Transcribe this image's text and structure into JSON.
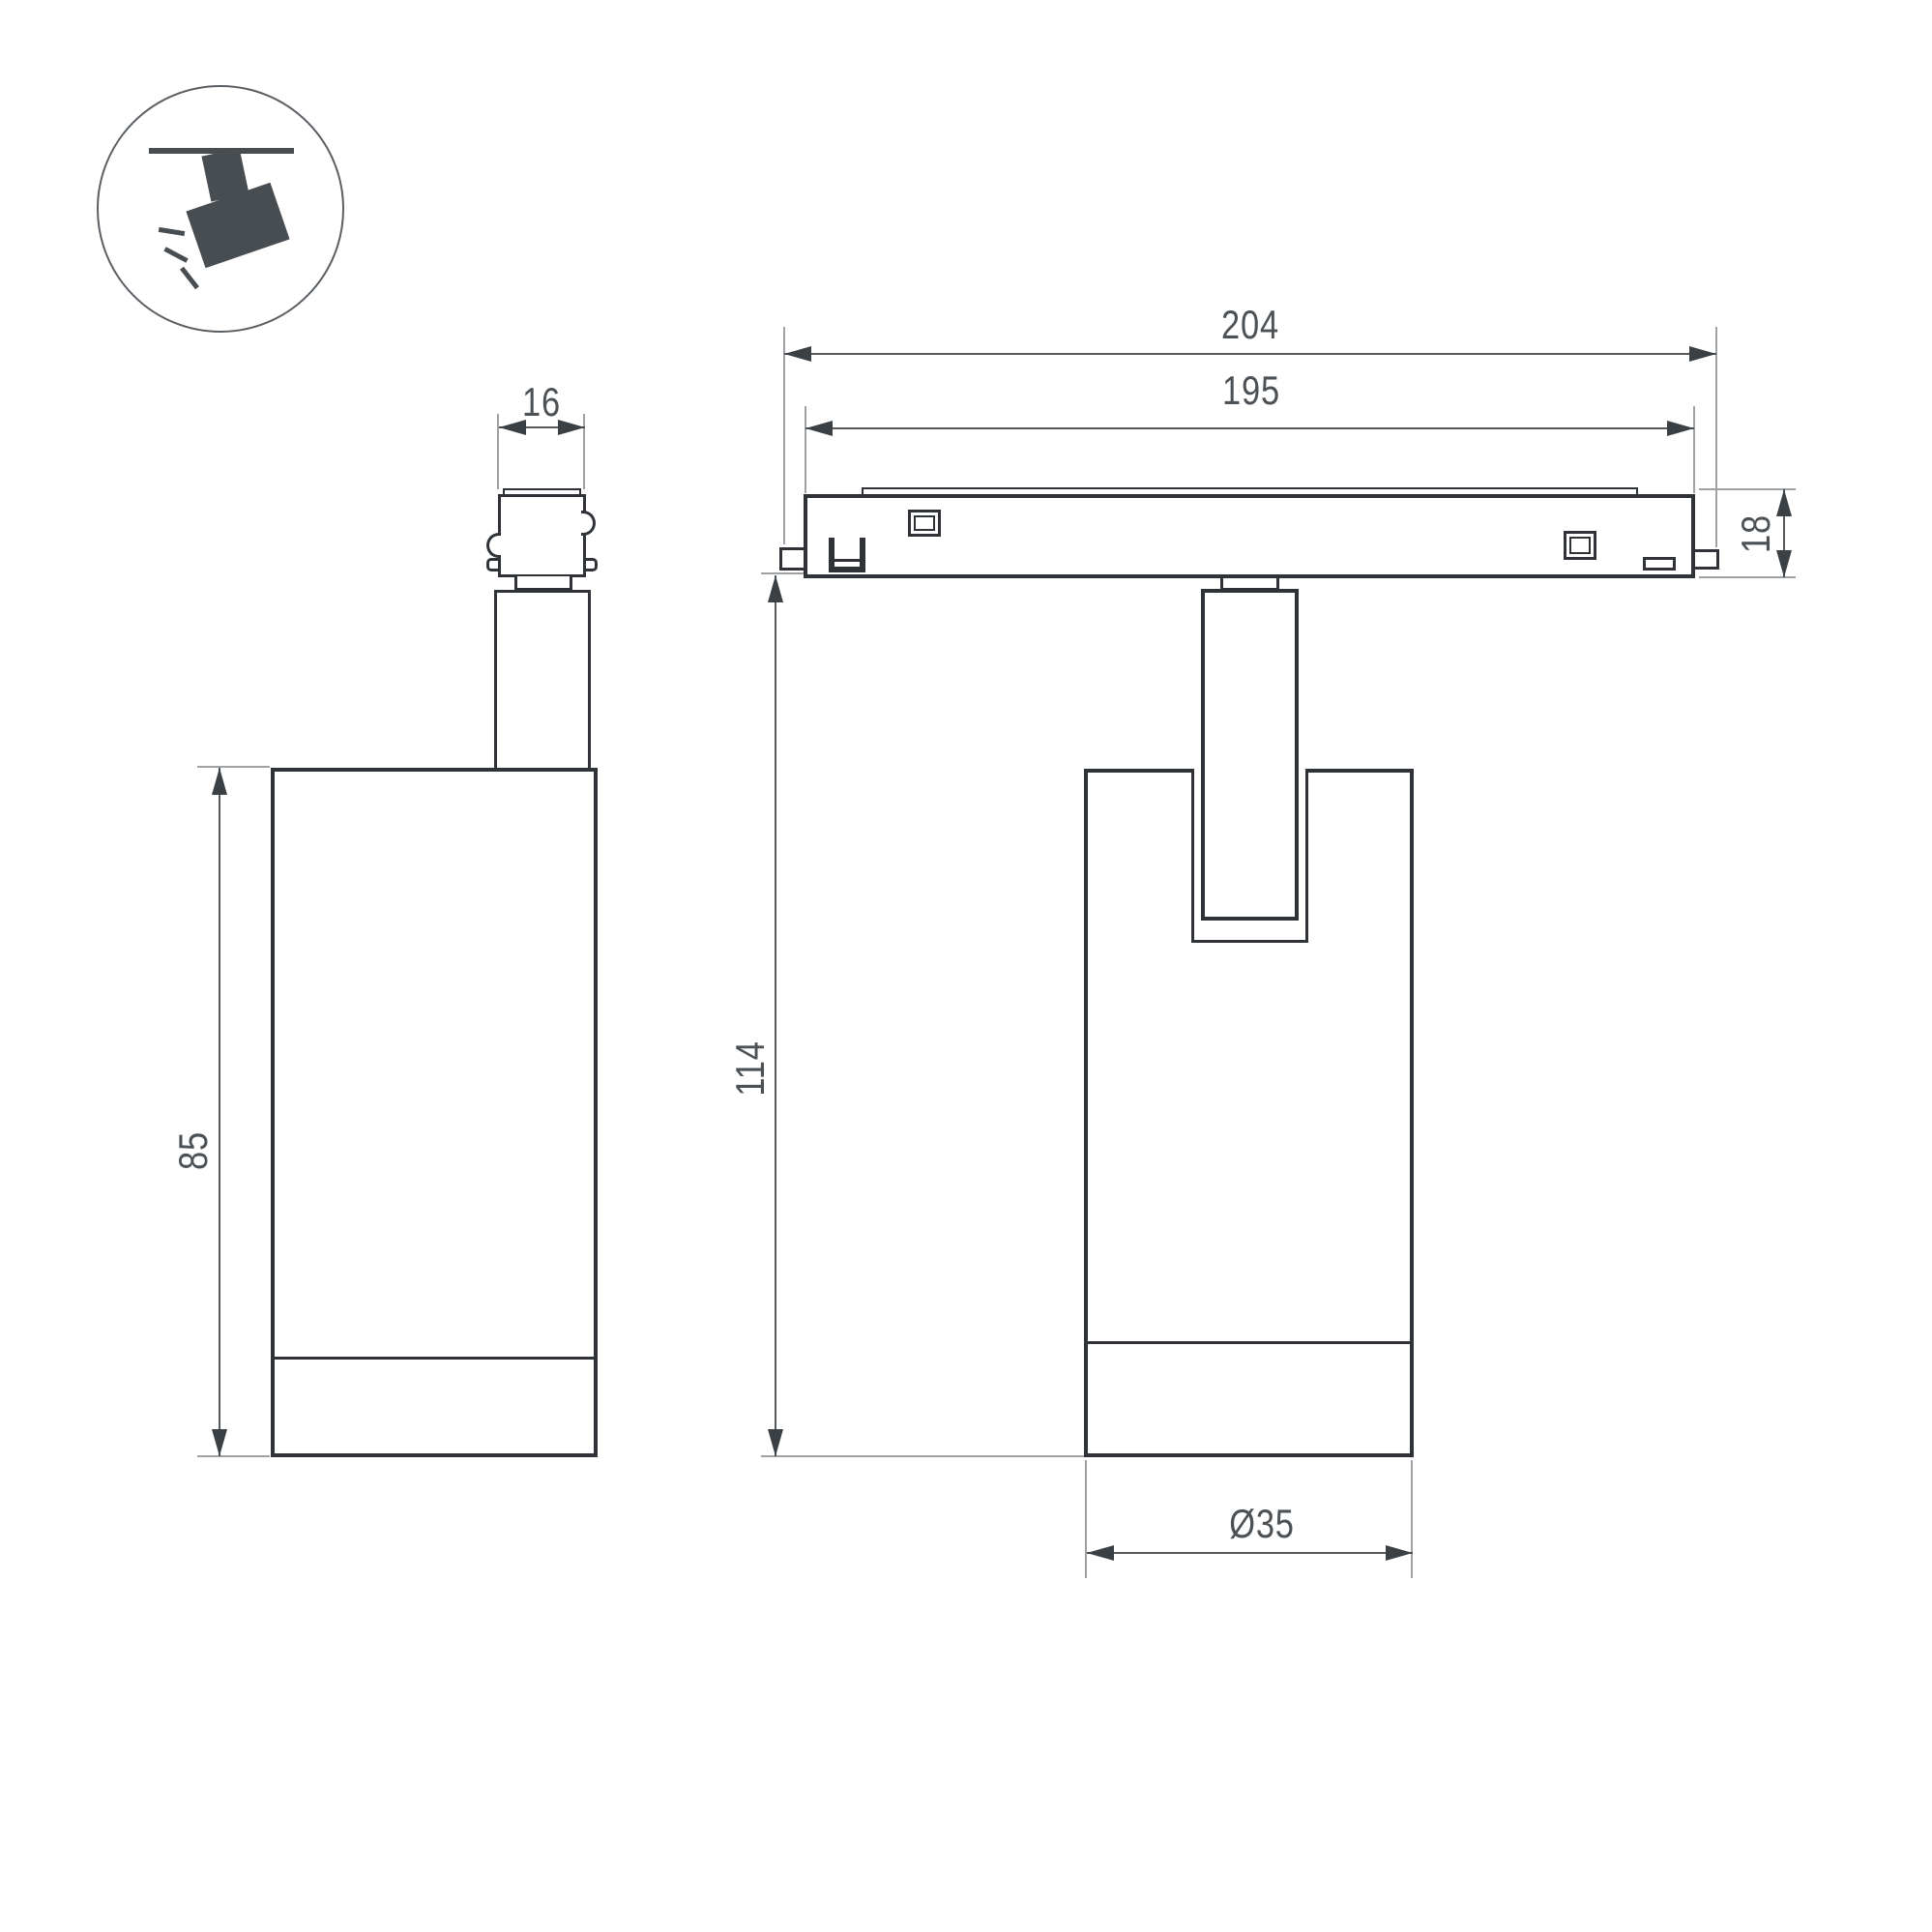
{
  "icon": {
    "name": "track-spotlight"
  },
  "dimensions": {
    "adapter_width": "16",
    "body_height": "85",
    "track_length_outer": "204",
    "track_length_inner": "195",
    "track_height": "18",
    "total_height": "114",
    "body_diameter": "Ø35"
  },
  "colors": {
    "outline": "#2f3337",
    "dimension_line": "#55595d",
    "extension_line": "#9ea2a5",
    "arrow": "#3b4044",
    "label": "#4c5156",
    "icon_fill": "#484d52"
  }
}
